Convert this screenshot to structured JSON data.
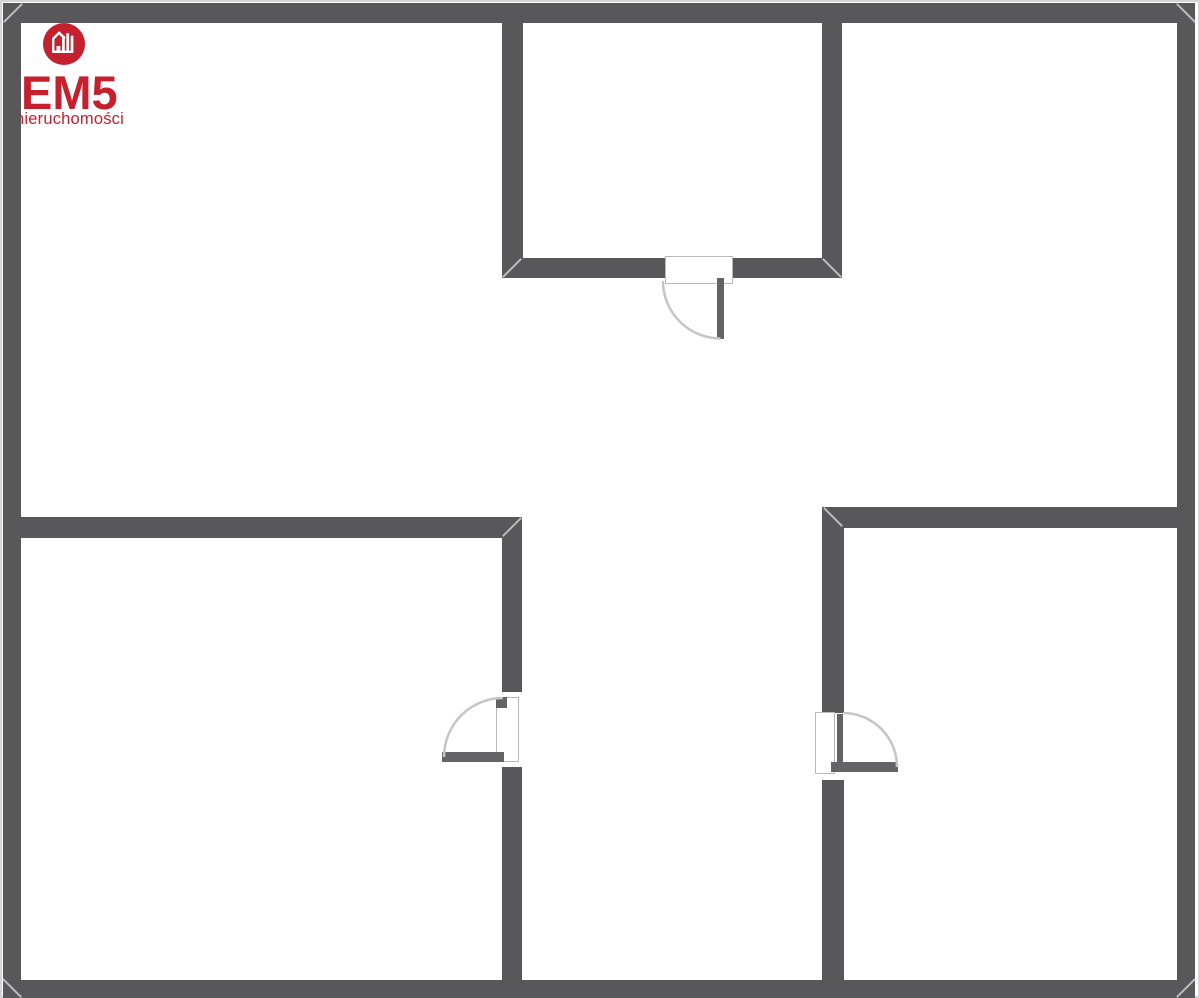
{
  "logo": {
    "brand": "EM5",
    "tagline": "nieruchomości",
    "brand_color": "#c5202e",
    "icon": "house-buildings-icon"
  },
  "floorplan": {
    "canvas": {
      "width": 1200,
      "height": 998,
      "background": "#ffffff"
    },
    "wall_color": "#58585a",
    "wall_edge_color": "#d4d4d4",
    "door_arc_color": "#c5c5c5",
    "door_leaf_color": "#646467",
    "door_panel_border": "#b9b9b9",
    "walls": [
      {
        "name": "outer-wall-top",
        "x": 3,
        "y": 3,
        "w": 1192,
        "h": 20
      },
      {
        "name": "outer-wall-left",
        "x": 3,
        "y": 3,
        "w": 18,
        "h": 995
      },
      {
        "name": "outer-wall-right",
        "x": 1177,
        "y": 3,
        "w": 18,
        "h": 995
      },
      {
        "name": "outer-wall-bottom",
        "x": 3,
        "y": 980,
        "w": 1192,
        "h": 18
      },
      {
        "name": "top-room-left-wall",
        "x": 502,
        "y": 23,
        "w": 21,
        "h": 255
      },
      {
        "name": "top-room-right-wall",
        "x": 822,
        "y": 23,
        "w": 20,
        "h": 255
      },
      {
        "name": "top-room-bottom-wall-left",
        "x": 502,
        "y": 258,
        "w": 163,
        "h": 20
      },
      {
        "name": "top-room-bottom-wall-right",
        "x": 733,
        "y": 258,
        "w": 109,
        "h": 20
      },
      {
        "name": "left-room-top-wall",
        "x": 21,
        "y": 517,
        "w": 501,
        "h": 21
      },
      {
        "name": "left-room-right-wall-upper",
        "x": 502,
        "y": 517,
        "w": 20,
        "h": 175
      },
      {
        "name": "left-room-right-wall-lower",
        "x": 502,
        "y": 767,
        "w": 20,
        "h": 213
      },
      {
        "name": "right-room-top-wall",
        "x": 822,
        "y": 507,
        "w": 355,
        "h": 21
      },
      {
        "name": "right-room-left-wall-upper",
        "x": 822,
        "y": 507,
        "w": 22,
        "h": 206
      },
      {
        "name": "right-room-left-wall-lower",
        "x": 822,
        "y": 780,
        "w": 22,
        "h": 200
      }
    ],
    "miters": [
      {
        "name": "miter-outer-top-left",
        "cx": 13,
        "cy": 13,
        "angle": -45
      },
      {
        "name": "miter-outer-top-right",
        "cx": 1186,
        "cy": 13,
        "angle": 45
      },
      {
        "name": "miter-outer-bottom-right",
        "cx": 1186,
        "cy": 988,
        "angle": -45
      },
      {
        "name": "miter-outer-bottom-left",
        "cx": 12,
        "cy": 988,
        "angle": 45
      },
      {
        "name": "miter-top-room-bottom-left",
        "cx": 512,
        "cy": 268,
        "angle": -45
      },
      {
        "name": "miter-top-room-bottom-right",
        "cx": 832,
        "cy": 268,
        "angle": 45
      },
      {
        "name": "miter-left-wall-corner",
        "cx": 512,
        "cy": 527,
        "angle": -45
      },
      {
        "name": "miter-right-wall-corner",
        "cx": 833,
        "cy": 517,
        "angle": 45
      }
    ],
    "doors": [
      {
        "name": "top-room-door",
        "parts": [
          {
            "type": "panel",
            "x": 665,
            "y": 256,
            "w": 68,
            "h": 28
          },
          {
            "type": "leaf",
            "x": 717,
            "y": 278,
            "w": 7,
            "h": 61
          }
        ],
        "arc": "M 663 281 A 57.5 57.5 0 0 0 720.5 338.5"
      },
      {
        "name": "left-room-door",
        "parts": [
          {
            "type": "panel",
            "x": 496,
            "y": 697,
            "w": 23,
            "h": 65
          },
          {
            "type": "block",
            "x": 496,
            "y": 697,
            "w": 11,
            "h": 11
          },
          {
            "type": "leaf",
            "x": 442,
            "y": 752,
            "w": 62,
            "h": 10
          }
        ],
        "arc": "M 444 757 A 59 59 0 0 1 503 698"
      },
      {
        "name": "right-room-door",
        "parts": [
          {
            "type": "panel",
            "x": 815,
            "y": 712,
            "w": 20,
            "h": 62
          },
          {
            "type": "block",
            "x": 837,
            "y": 714,
            "w": 6,
            "h": 53
          },
          {
            "type": "leaf",
            "x": 831,
            "y": 762,
            "w": 67,
            "h": 10
          }
        ],
        "arc": "M 843 713 A 54 54 0 0 1 897 767"
      }
    ]
  }
}
